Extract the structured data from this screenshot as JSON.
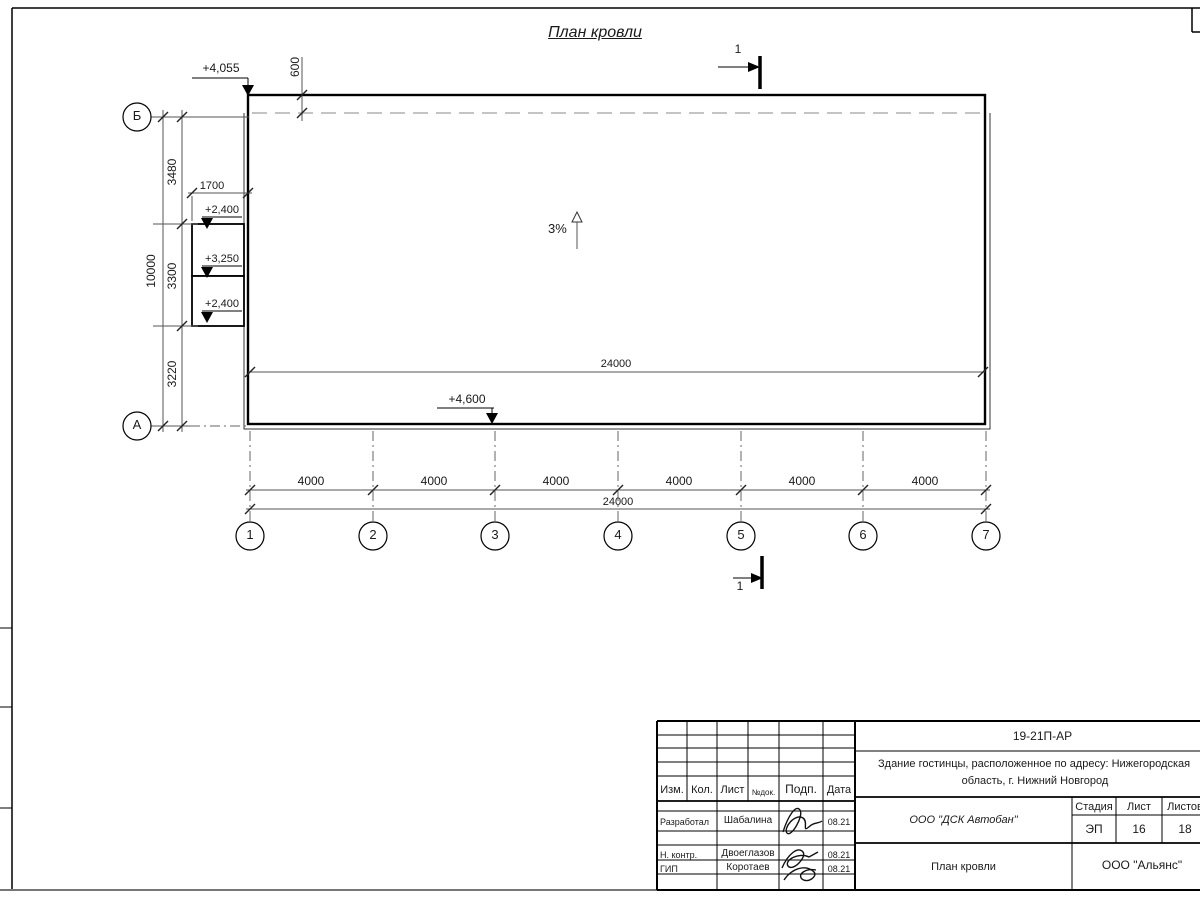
{
  "title": "План кровли",
  "section_mark": {
    "label": "1"
  },
  "plan": {
    "slope_label": "3%",
    "elevations": {
      "top_left": "+4,055",
      "bottom": "+4,600",
      "canopy_top": "+2,400",
      "canopy_mid": "+3,250",
      "canopy_bottom": "+2,400"
    },
    "dimensions": {
      "overhang": "600",
      "canopy_width": "1700",
      "left_chain": [
        "3480",
        "3300",
        "3220"
      ],
      "left_total": "10000",
      "inner_width": "24000",
      "bottom_spacings": [
        "4000",
        "4000",
        "4000",
        "4000",
        "4000",
        "4000"
      ],
      "bottom_total": "24000"
    },
    "axes": {
      "horizontal": [
        "Б",
        "А"
      ],
      "vertical": [
        "1",
        "2",
        "3",
        "4",
        "5",
        "6",
        "7"
      ]
    }
  },
  "title_block": {
    "doc_number": "19-21П-АР",
    "project_name_line1": "Здание гостинцы, расположенное по адресу: Нижегородская",
    "project_name_line2": "область, г. Нижний Новгород",
    "columns": {
      "izm": "Изм.",
      "kol": "Кол.",
      "list": "Лист",
      "ndok": "№док.",
      "podp": "Подп.",
      "data": "Дата"
    },
    "rows": [
      {
        "role": "Разработал",
        "name": "Шабалина",
        "date": "08.21"
      },
      {
        "role": "Н. контр.",
        "name": "Двоеглазов",
        "date": "08.21"
      },
      {
        "role": "ГИП",
        "name": "Коротаев",
        "date": "08.21"
      }
    ],
    "company": "ООО \"ДСК Автобан\"",
    "stage_label": "Стадия",
    "sheet_label": "Лист",
    "sheets_label": "Листов",
    "stage": "ЭП",
    "sheet": "16",
    "sheets": "18",
    "drawing_name": "План кровли",
    "org": "ООО \"Альянс\""
  }
}
